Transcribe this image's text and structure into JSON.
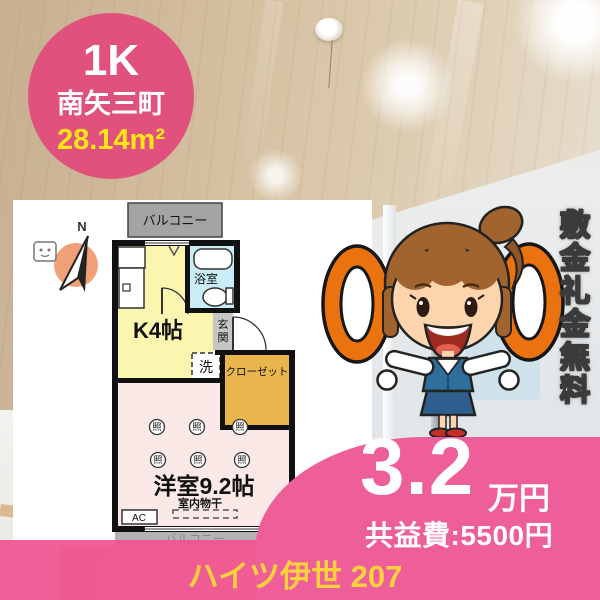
{
  "badge": {
    "layout": "1K",
    "district": "南矢三町",
    "area": "28.14m²"
  },
  "floorplan": {
    "compass_label": "N",
    "balcony_top": "バルコニー",
    "balcony_bottom": "バルコニー",
    "kitchen": "K4帖",
    "bath": "浴室",
    "entrance_chars": [
      "玄",
      "関"
    ],
    "washer": "洗",
    "closet": "クローゼット",
    "room": "洋室9.2帖",
    "lights": [
      "照",
      "照",
      "照",
      "照",
      "照",
      "照"
    ],
    "indoor_drying": "室内物干",
    "ac_label": "AC"
  },
  "promo": {
    "vertical_banner": "敷金礼金無料",
    "zero_symbols": [
      "0",
      "0"
    ]
  },
  "price": {
    "amount": "3.2",
    "unit": "万円",
    "common_fee": "共益費:5500円"
  },
  "footer": {
    "property_name": "ハイツ伊世 207"
  },
  "colors": {
    "badge_pink": "#e0517d",
    "overlay_pink": "#ee5f9a",
    "accent_yellow": "#ffe515",
    "footer_yellow": "#fcd23c",
    "zero_orange": "#ea720f"
  }
}
